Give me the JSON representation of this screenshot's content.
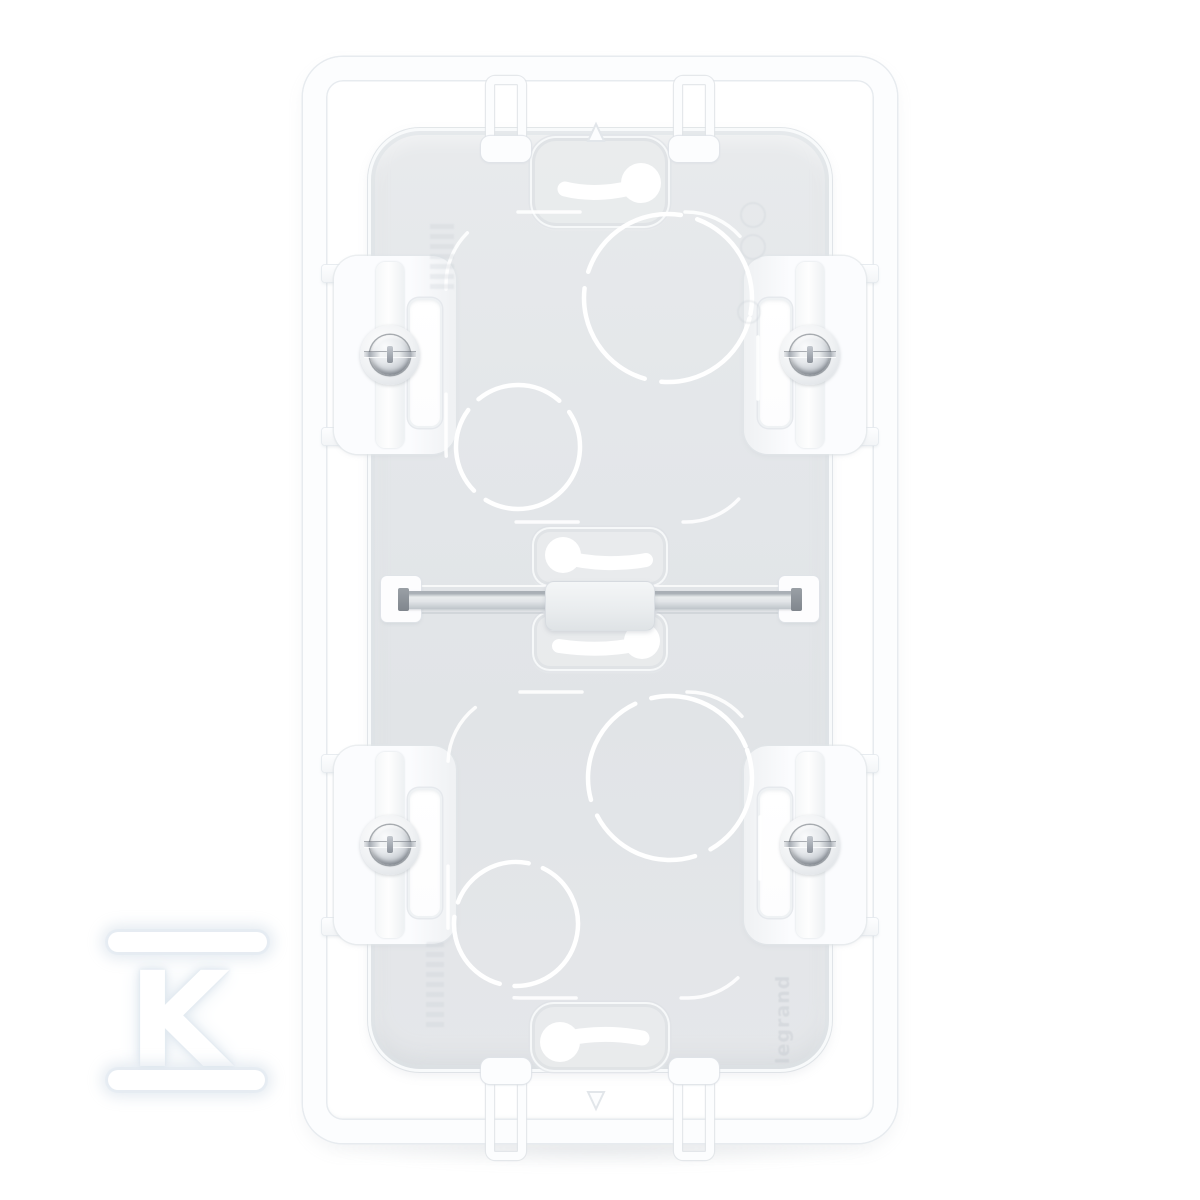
{
  "meta": {
    "type": "product-photo",
    "subject": "White plastic 2-gang vertical surface-mount electrical back box, front view on white background"
  },
  "watermark": {
    "letter": "K"
  },
  "embossed": {
    "brand": "legrand"
  },
  "product": {
    "gang_count": 2,
    "screw_count": 4,
    "keyhole_slot_count": 4,
    "knockout_circle_count": 4,
    "clip_tab_count": 4
  },
  "colors": {
    "background": "#ffffff",
    "frame": "#fcfdfe",
    "frame_edge": "#e7ebef",
    "body": "#e3e6e9",
    "knockout": "#ffffff",
    "screw_metal": "#c6cbd1",
    "bar_metal": "#c9ced3",
    "watermark_fill": "#ffffff",
    "watermark_glow": "#e4ebf1"
  }
}
